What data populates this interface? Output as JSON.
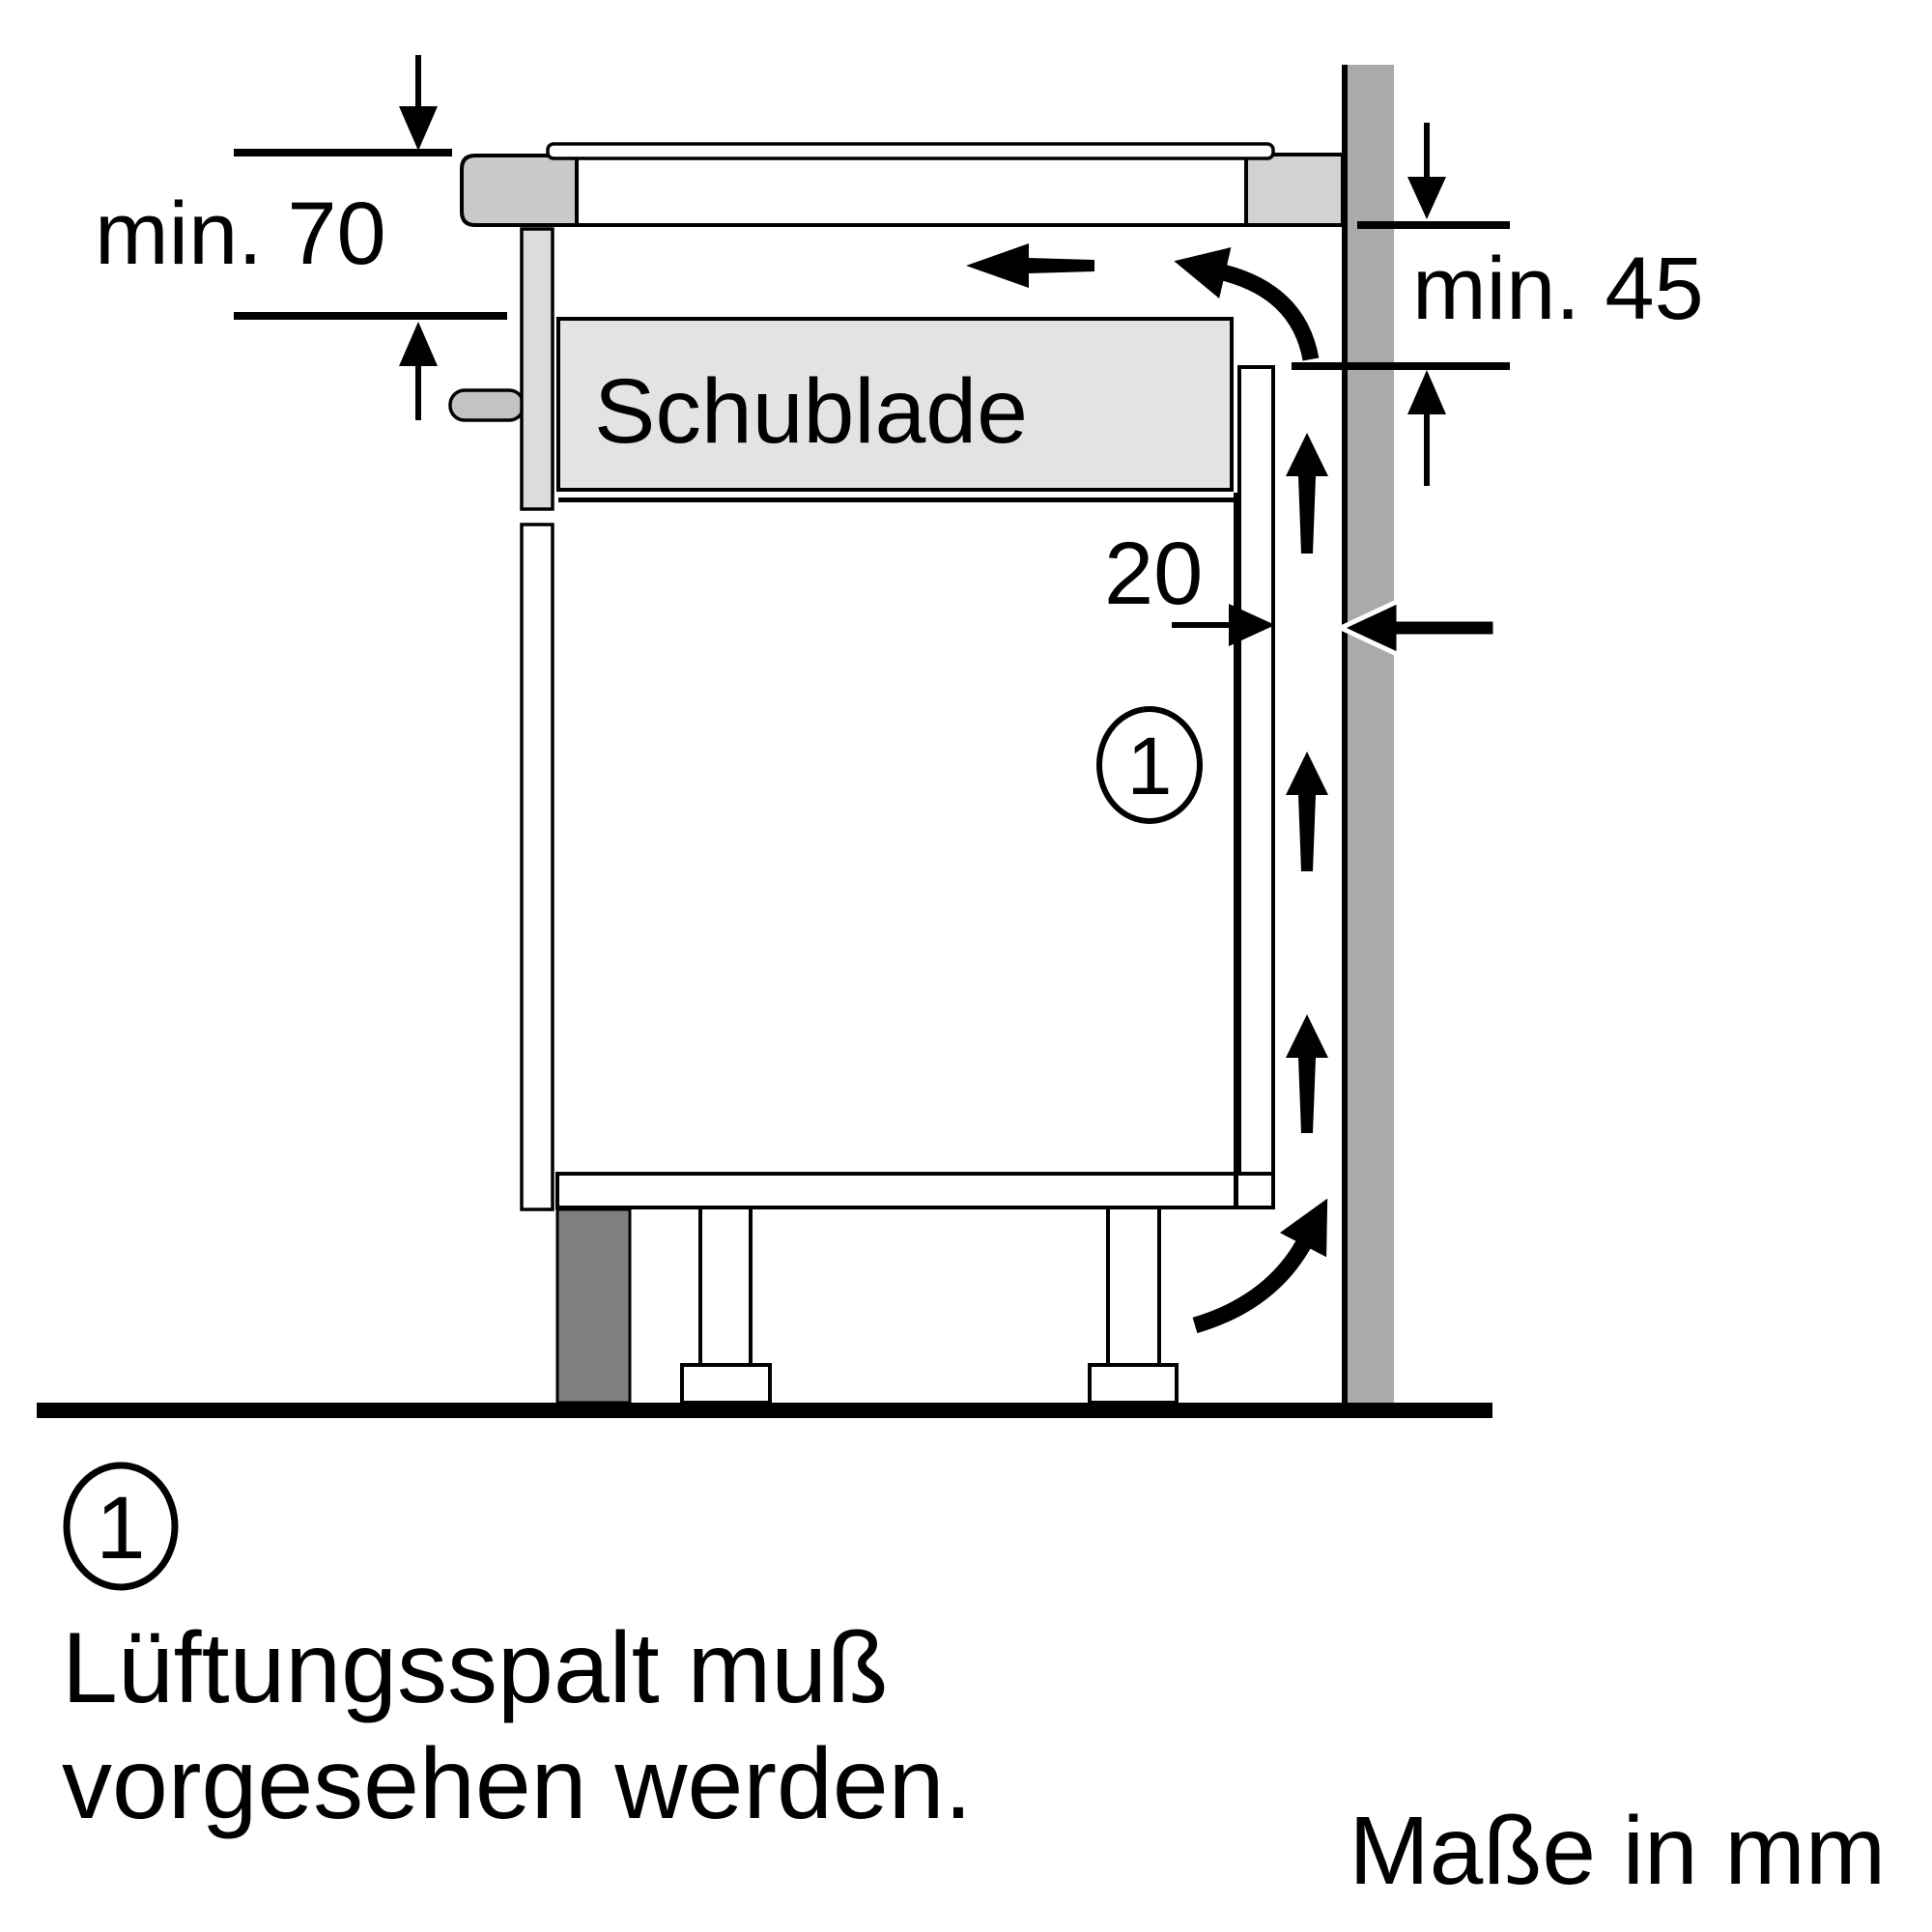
{
  "diagram": {
    "type": "hob-installation-cross-section",
    "labels": {
      "dim_worktop_to_drawer": "min. 70",
      "dim_wall_clearance": "min. 45",
      "dim_vent_gap": "20",
      "drawer": "Schublade",
      "callout_number": "1"
    },
    "legend": {
      "marker": "1",
      "line1": "Lüftungsspalt muß",
      "line2": "vorgesehen werden."
    },
    "footer": "Maße in mm",
    "colors": {
      "line": "#000000",
      "wall": "#aaaaaa",
      "plinth": "#7f7f7f",
      "hob_body": "#c9c9c9",
      "worktop_end": "#d2d2d2",
      "drawer_fill": "#e3e3e3",
      "front_panel": "#dcdcdc",
      "handle": "#c3c3c3",
      "background": "#ffffff"
    }
  }
}
